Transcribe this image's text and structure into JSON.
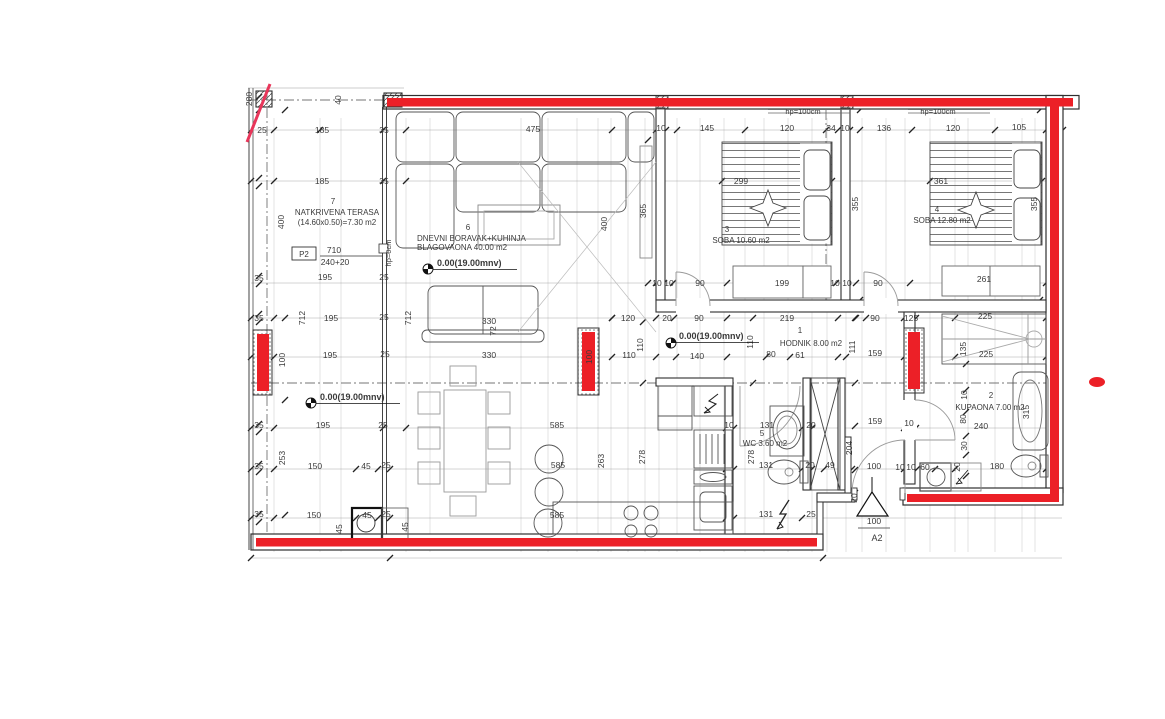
{
  "drawing_type": "apartment floor plan",
  "colors": {
    "wall_red": "#ec2027",
    "accent_pink": "#e8365a",
    "line_dark": "#2f2f2f",
    "furniture_gray": "#7d7d7d",
    "dim_text": "#3a3a3a",
    "room_text": "#6b6b6b"
  },
  "rooms": [
    {
      "number": "1",
      "label_lines": [
        "HODNIK 8.00 m2"
      ],
      "num_pos": [
        800,
        333
      ],
      "line_pos": [
        [
          811,
          346
        ]
      ]
    },
    {
      "number": "2",
      "label_lines": [
        "KUPAONA 7.00 m2"
      ],
      "num_pos": [
        991,
        398
      ],
      "line_pos": [
        [
          990,
          410
        ]
      ]
    },
    {
      "number": "3",
      "label_lines": [
        "SOBA 10.60 m2"
      ],
      "num_pos": [
        727,
        232
      ],
      "line_pos": [
        [
          741,
          243
        ]
      ]
    },
    {
      "number": "4",
      "label_lines": [
        "SOBA 12.80 m2"
      ],
      "num_pos": [
        937,
        212
      ],
      "line_pos": [
        [
          942,
          223
        ]
      ]
    },
    {
      "number": "5",
      "label_lines": [
        "WC 3.60 m2"
      ],
      "num_pos": [
        762,
        436
      ],
      "line_pos": [
        [
          765,
          446
        ]
      ]
    },
    {
      "number": "6",
      "label_lines": [
        "DNEVNI BORAVAK+KUHINJA",
        "BLAGOVAONA 40.00 m2"
      ],
      "num_pos": [
        468,
        230
      ],
      "line_pos": [
        [
          417,
          241,
          "start"
        ],
        [
          417,
          250,
          "start"
        ]
      ]
    },
    {
      "number": "7",
      "label_lines": [
        "NATKRIVENA TERASA",
        "(14.60x0.50)=7.30 m2"
      ],
      "num_pos": [
        333,
        204
      ],
      "line_pos": [
        [
          337,
          215
        ],
        [
          337,
          225
        ]
      ]
    }
  ],
  "dimensions": [
    {
      "t": "25",
      "x": 262,
      "y": 133
    },
    {
      "t": "185",
      "x": 322,
      "y": 133
    },
    {
      "t": "35",
      "x": 384,
      "y": 133
    },
    {
      "t": "475",
      "x": 533,
      "y": 132
    },
    {
      "t": "10",
      "x": 661,
      "y": 131
    },
    {
      "t": "145",
      "x": 707,
      "y": 131
    },
    {
      "t": "120",
      "x": 787,
      "y": 131
    },
    {
      "t": "34",
      "x": 831,
      "y": 131
    },
    {
      "t": "10",
      "x": 845,
      "y": 131
    },
    {
      "t": "136",
      "x": 884,
      "y": 131
    },
    {
      "t": "120",
      "x": 953,
      "y": 131
    },
    {
      "t": "105",
      "x": 1019,
      "y": 130
    },
    {
      "t": "185",
      "x": 322,
      "y": 184
    },
    {
      "t": "35",
      "x": 384,
      "y": 184
    },
    {
      "t": "299",
      "x": 741,
      "y": 184
    },
    {
      "t": "361",
      "x": 941,
      "y": 184
    },
    {
      "t": "35",
      "x": 259,
      "y": 281
    },
    {
      "t": "195",
      "x": 325,
      "y": 280
    },
    {
      "t": "25",
      "x": 384,
      "y": 280
    },
    {
      "t": "10",
      "x": 657,
      "y": 286
    },
    {
      "t": "10",
      "x": 669,
      "y": 286
    },
    {
      "t": "90",
      "x": 700,
      "y": 286
    },
    {
      "t": "199",
      "x": 782,
      "y": 286
    },
    {
      "t": "10",
      "x": 835,
      "y": 286
    },
    {
      "t": "10",
      "x": 847,
      "y": 286
    },
    {
      "t": "90",
      "x": 878,
      "y": 286
    },
    {
      "t": "261",
      "x": 984,
      "y": 282
    },
    {
      "t": "35",
      "x": 259,
      "y": 321
    },
    {
      "t": "195",
      "x": 331,
      "y": 321
    },
    {
      "t": "25",
      "x": 384,
      "y": 320
    },
    {
      "t": "120",
      "x": 628,
      "y": 321
    },
    {
      "t": "20",
      "x": 667,
      "y": 321
    },
    {
      "t": "90",
      "x": 699,
      "y": 321
    },
    {
      "t": "219",
      "x": 787,
      "y": 321
    },
    {
      "t": "90",
      "x": 875,
      "y": 321
    },
    {
      "t": "125",
      "x": 911,
      "y": 321
    },
    {
      "t": "225",
      "x": 985,
      "y": 319
    },
    {
      "t": "195",
      "x": 330,
      "y": 358
    },
    {
      "t": "25",
      "x": 385,
      "y": 357
    },
    {
      "t": "110",
      "x": 629,
      "y": 358
    },
    {
      "t": "140",
      "x": 697,
      "y": 359
    },
    {
      "t": "80",
      "x": 771,
      "y": 357
    },
    {
      "t": "61",
      "x": 800,
      "y": 358
    },
    {
      "t": "159",
      "x": 875,
      "y": 356
    },
    {
      "t": "225",
      "x": 986,
      "y": 357
    },
    {
      "t": "35",
      "x": 259,
      "y": 428
    },
    {
      "t": "195",
      "x": 323,
      "y": 428
    },
    {
      "t": "25",
      "x": 383,
      "y": 428
    },
    {
      "t": "585",
      "x": 557,
      "y": 428
    },
    {
      "t": "10",
      "x": 729,
      "y": 428
    },
    {
      "t": "131",
      "x": 767,
      "y": 428
    },
    {
      "t": "20",
      "x": 811,
      "y": 428
    },
    {
      "t": "159",
      "x": 875,
      "y": 424
    },
    {
      "t": "10",
      "x": 909,
      "y": 426
    },
    {
      "t": "240",
      "x": 981,
      "y": 429
    },
    {
      "t": "35",
      "x": 259,
      "y": 469
    },
    {
      "t": "150",
      "x": 315,
      "y": 469
    },
    {
      "t": "45",
      "x": 366,
      "y": 469
    },
    {
      "t": "25",
      "x": 386,
      "y": 468
    },
    {
      "t": "585",
      "x": 558,
      "y": 468
    },
    {
      "t": "131",
      "x": 766,
      "y": 468
    },
    {
      "t": "20",
      "x": 810,
      "y": 468
    },
    {
      "t": "49",
      "x": 830,
      "y": 468
    },
    {
      "t": "100",
      "x": 874,
      "y": 469
    },
    {
      "t": "10",
      "x": 900,
      "y": 470
    },
    {
      "t": "10",
      "x": 911,
      "y": 470
    },
    {
      "t": "60",
      "x": 925,
      "y": 470
    },
    {
      "t": "180",
      "x": 997,
      "y": 469
    },
    {
      "t": "35",
      "x": 259,
      "y": 517
    },
    {
      "t": "150",
      "x": 314,
      "y": 518
    },
    {
      "t": "45",
      "x": 367,
      "y": 518
    },
    {
      "t": "25",
      "x": 386,
      "y": 517
    },
    {
      "t": "585",
      "x": 557,
      "y": 518
    },
    {
      "t": "131",
      "x": 766,
      "y": 517
    },
    {
      "t": "25",
      "x": 811,
      "y": 517
    },
    {
      "t": "280",
      "x": 252,
      "y": 99,
      "r": -90
    },
    {
      "t": "40",
      "x": 341,
      "y": 100,
      "r": -90
    },
    {
      "t": "400",
      "x": 284,
      "y": 222,
      "r": -90
    },
    {
      "t": "712",
      "x": 305,
      "y": 318,
      "r": -90
    },
    {
      "t": "712",
      "x": 411,
      "y": 318,
      "r": -90
    },
    {
      "t": "100",
      "x": 285,
      "y": 360,
      "r": -90
    },
    {
      "t": "253",
      "x": 285,
      "y": 458,
      "r": -90
    },
    {
      "t": "400",
      "x": 607,
      "y": 224,
      "r": -90
    },
    {
      "t": "365",
      "x": 646,
      "y": 211,
      "r": -90
    },
    {
      "t": "355",
      "x": 858,
      "y": 204,
      "r": -90
    },
    {
      "t": "355",
      "x": 1037,
      "y": 204,
      "r": -90
    },
    {
      "t": "110",
      "x": 643,
      "y": 345,
      "r": -90
    },
    {
      "t": "110",
      "x": 753,
      "y": 342,
      "r": -90
    },
    {
      "t": "111",
      "x": 855,
      "y": 347,
      "r": -90
    },
    {
      "t": "135",
      "x": 966,
      "y": 349,
      "r": -90
    },
    {
      "t": "100",
      "x": 592,
      "y": 357,
      "r": -90
    },
    {
      "t": "10",
      "x": 967,
      "y": 395,
      "r": -90
    },
    {
      "t": "80",
      "x": 966,
      "y": 419,
      "r": -90
    },
    {
      "t": "30",
      "x": 967,
      "y": 446,
      "r": -90
    },
    {
      "t": "20",
      "x": 960,
      "y": 467,
      "r": -90
    },
    {
      "t": "315",
      "x": 1029,
      "y": 412,
      "r": -90
    },
    {
      "t": "263",
      "x": 604,
      "y": 461,
      "r": -90
    },
    {
      "t": "278",
      "x": 645,
      "y": 457,
      "r": -90
    },
    {
      "t": "278",
      "x": 754,
      "y": 457,
      "r": -90
    },
    {
      "t": "204",
      "x": 852,
      "y": 448,
      "r": -90
    },
    {
      "t": "20",
      "x": 857,
      "y": 498,
      "r": -90
    },
    {
      "t": "45",
      "x": 342,
      "y": 529,
      "r": -90
    },
    {
      "t": "45",
      "x": 408,
      "y": 527,
      "r": -90
    },
    {
      "t": "330",
      "x": 489,
      "y": 324
    },
    {
      "t": "72",
      "x": 496,
      "y": 331,
      "r": -90
    },
    {
      "t": "330",
      "x": 489,
      "y": 358
    }
  ],
  "annotations": {
    "elevation_label": "0.00(19.00mnv)",
    "elevation_marks": [
      {
        "x": 437,
        "y": 266,
        "mx": 428,
        "my": 269
      },
      {
        "x": 679,
        "y": 339,
        "mx": 671,
        "my": 343
      },
      {
        "x": 320,
        "y": 400,
        "mx": 311,
        "my": 403
      }
    ],
    "parapet_labels": [
      {
        "t": "hp=100cm",
        "x": 803,
        "y": 114
      },
      {
        "t": "hp=100cm",
        "x": 938,
        "y": 114
      },
      {
        "t": "hp=0cm",
        "x": 391,
        "y": 253,
        "r": -90
      }
    ],
    "floor_label": {
      "code": "P2",
      "top": "710",
      "bottom": "240+20"
    },
    "section_marker": {
      "label": "A2",
      "dim": "100"
    }
  }
}
